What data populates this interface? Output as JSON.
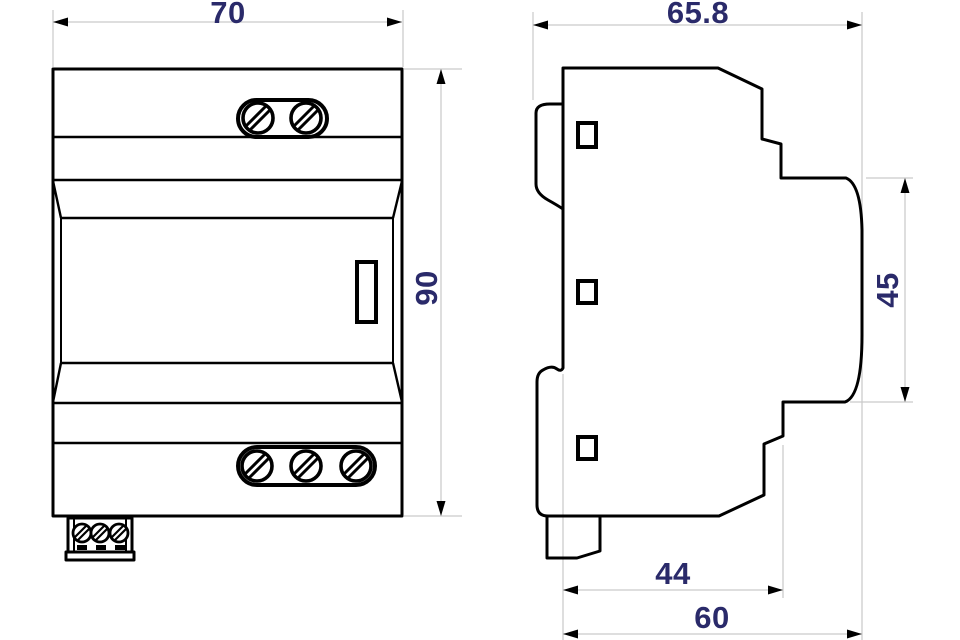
{
  "colors": {
    "background": "#ffffff",
    "outline": "#000000",
    "dimension_line": "#c9c9c9",
    "dimension_text": "#2a2a6a"
  },
  "views": {
    "front": {
      "dimensions": {
        "width": "70",
        "height": "90"
      }
    },
    "side": {
      "dimensions": {
        "depth": "65.8",
        "front_height": "45",
        "lower_depth": "44",
        "overall_depth": "60"
      }
    }
  }
}
